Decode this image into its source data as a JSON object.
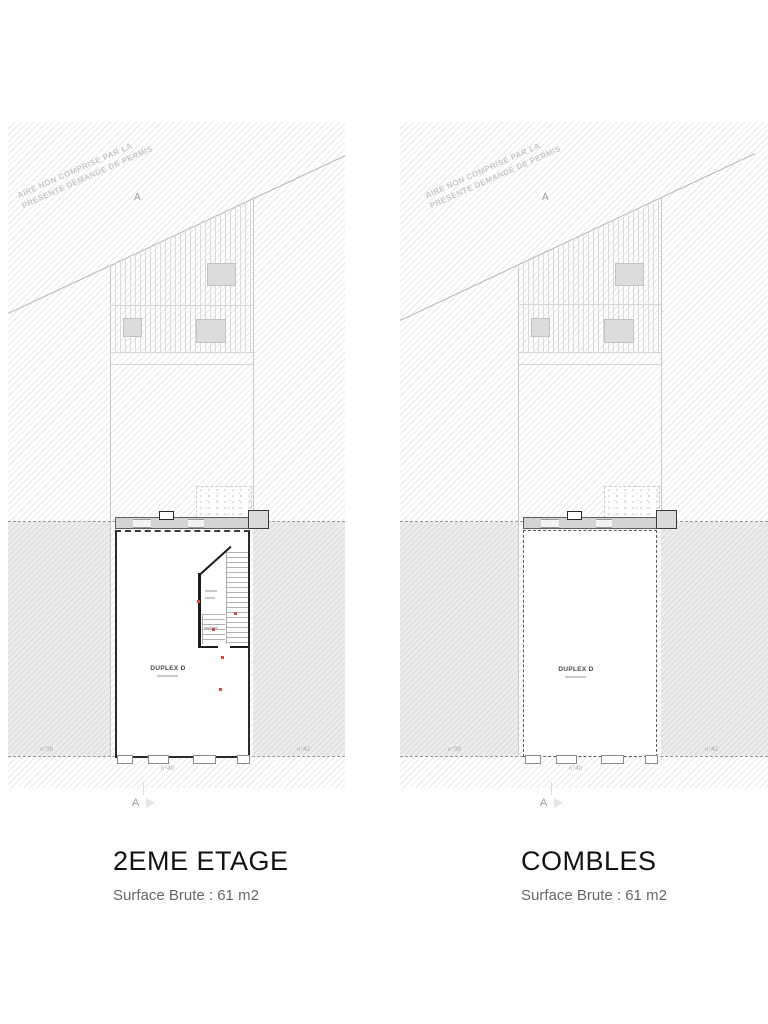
{
  "document": {
    "type": "architectural floor plans",
    "background": "#ffffff"
  },
  "plans": [
    {
      "title": "2EME ETAGE",
      "subtitle": "Surface Brute : 61 m2",
      "unit_label": "DUPLEX D",
      "disclaimer": [
        "AIRE NON COMPRISE PAR LA",
        "PRESENTE DEMANDE DE PERMIS"
      ],
      "section_marker_top": "A",
      "section_marker_bottom": "A",
      "neighbor_left": "n°38",
      "neighbor_right": "n°42",
      "street_number": "n°40"
    },
    {
      "title": "COMBLES",
      "subtitle": "Surface Brute : 61 m2",
      "unit_label": "DUPLEX D",
      "disclaimer": [
        "AIRE NON COMPRISE PAR LA",
        "PRESENTE DEMANDE DE PERMIS"
      ],
      "section_marker_top": "A",
      "section_marker_bottom": "A",
      "neighbor_left": "n°38",
      "neighbor_right": "n°42",
      "street_number": "n°40"
    }
  ],
  "colors": {
    "hatch_line": "#e3e3e3",
    "neighbor_fill": "#ececec",
    "wall": "#1c1c1c",
    "accent_red": "#d14b4b",
    "drawing_line": "#b4b4b4",
    "title_text": "#121212",
    "subtitle_text": "#676767"
  }
}
